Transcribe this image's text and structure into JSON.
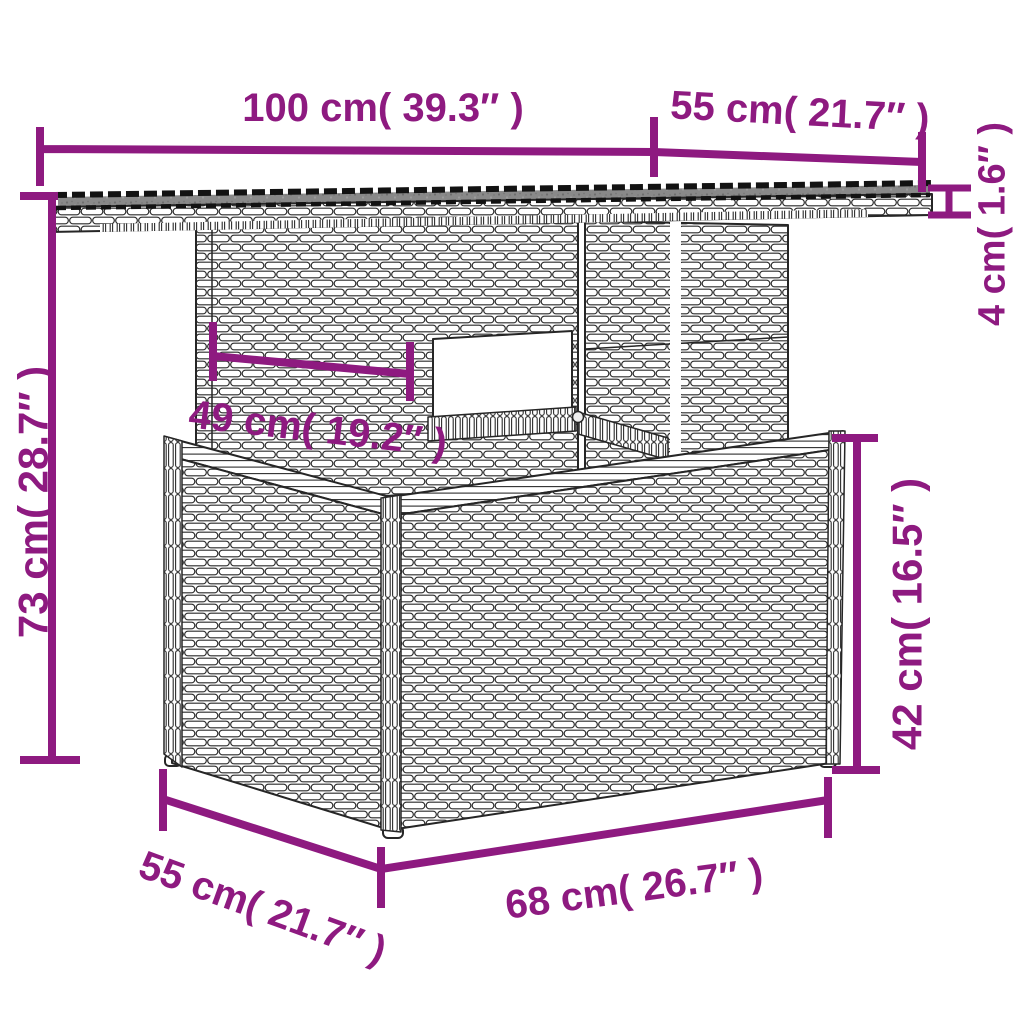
{
  "colors": {
    "accent": "#8e1a80",
    "line": "#262626",
    "background": "#ffffff",
    "glass": "#898989"
  },
  "dimensions": [
    {
      "id": "tabletop-width",
      "cm": 100,
      "inch": 39.3,
      "label": "100 cm( 39.3″ )"
    },
    {
      "id": "tabletop-depth",
      "cm": 55,
      "inch": 21.7,
      "label": "55 cm( 21.7″ )"
    },
    {
      "id": "tabletop-thickness",
      "cm": 4,
      "inch": 1.6,
      "label": "4 cm( 1.6″ )"
    },
    {
      "id": "overall-height",
      "cm": 73,
      "inch": 28.7,
      "label": "73 cm( 28.7″ )"
    },
    {
      "id": "pedestal-width",
      "cm": 49,
      "inch": 19.2,
      "label": "49 cm( 19.2″ )"
    },
    {
      "id": "base-height",
      "cm": 42,
      "inch": 16.5,
      "label": "42 cm( 16.5″ )"
    },
    {
      "id": "base-depth",
      "cm": 55,
      "inch": 21.7,
      "label": "55 cm( 21.7″ )"
    },
    {
      "id": "base-width",
      "cm": 68,
      "inch": 26.7,
      "label": "68 cm( 26.7″ )"
    }
  ]
}
